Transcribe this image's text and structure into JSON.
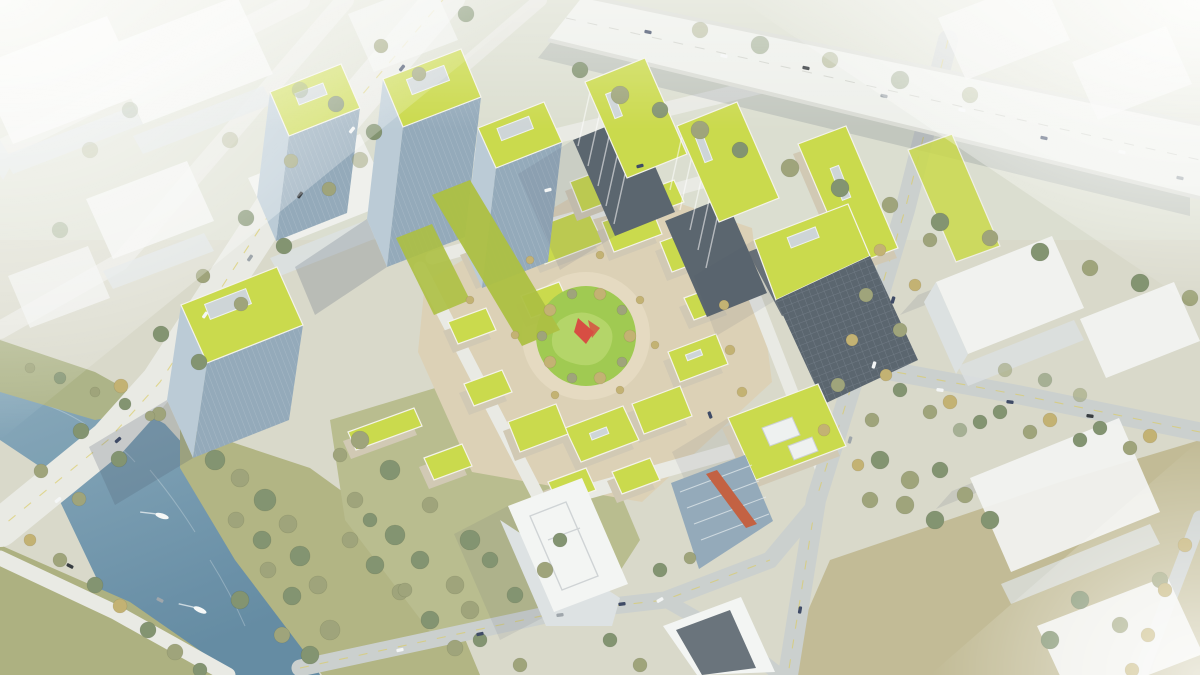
{
  "meta": {
    "type": "architectural-aerial-rendering",
    "description": "Bird's-eye architectural rendering of a mixed-use business campus: glass towers and mid-rise slabs with bright green roofs around a central courtyard cluster with a circular garden and red sculpture; a river with a road bridge and boats at lower left, an elevated highway across the upper right, and faded white context massing blocks at the edges."
  },
  "palette": {
    "water": "#7ba0b4",
    "water_deep": "#5d86a0",
    "roof_green": "#c8d845",
    "roof_green_shade": "#a9bd3a",
    "lawn": "#9bc84a",
    "park_olive": "#b6ba8b",
    "bank_olive": "#adb07e",
    "tree_green": "#7d8f6b",
    "tree_olive": "#9aa075",
    "tree_autumn": "#c0ae6d",
    "plaza_tan": "#dbcfb4",
    "road_light": "#e8e9e4",
    "road_grey": "#c9cecd",
    "highway": "#edefeb",
    "glass_light": "#b8c9d5",
    "glass_dark": "#8fa6b8",
    "facade_dark": "#535e69",
    "massing_white": "#f3f5f4",
    "massing_side": "#dce1e3",
    "wall_cream": "#cfc7b2",
    "sculpture_red": "#d5453a",
    "lane_yellow": "#d9ca5c",
    "haze": "#ffffff"
  },
  "scene": {
    "elements": [
      {
        "name": "river",
        "label": "river with two boats"
      },
      {
        "name": "bridge-road",
        "label": "tree-lined boulevard crossing the river on a bridge"
      },
      {
        "name": "elevated-highway",
        "label": "elevated highway with traffic, upper right"
      },
      {
        "name": "glass-tower-cluster",
        "label": "blue glass towers with green roofs, left of center"
      },
      {
        "name": "striped-slab-buildings",
        "label": "mid-rise slabs with striped facades and green roofs, top center"
      },
      {
        "name": "courtyard-cluster",
        "label": "low-rise courtyard blocks with yellow-green roofs around plaza"
      },
      {
        "name": "central-garden",
        "label": "circular lawn with red sculpture and ring of trees"
      },
      {
        "name": "dark-office-slab",
        "label": "dark gridded office slab with green roof, right of center"
      },
      {
        "name": "white-residential-buildings",
        "label": "white buildings at bottom center"
      },
      {
        "name": "context-massing",
        "label": "faded white context blocks at image edges"
      },
      {
        "name": "riverside-park",
        "label": "olive lawns and dense trees along the river"
      },
      {
        "name": "street-grid",
        "label": "diagonal street grid with cars and yellow lane lines"
      }
    ],
    "counts": {
      "boats": 2,
      "garden_ring_trees": 10
    }
  }
}
